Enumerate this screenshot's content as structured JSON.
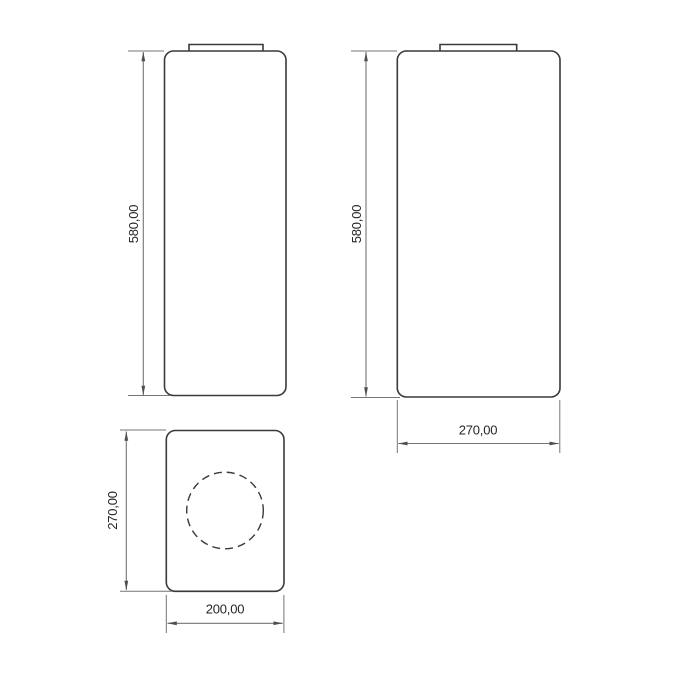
{
  "drawing": {
    "type": "technical-dimension-drawing",
    "views": {
      "front_view": {
        "name": "front-view",
        "height_dimension": "580,00"
      },
      "side_view": {
        "name": "side-view",
        "height_dimension": "580,00",
        "width_dimension": "270,00"
      },
      "top_view": {
        "name": "top-view",
        "height_dimension": "270,00",
        "width_dimension": "200,00"
      }
    },
    "colors": {
      "outline": "#3a3a3a",
      "dimension_lines": "#757575",
      "arrowheads": "#4f4f4f",
      "label_text": "#262626",
      "background": "#ffffff"
    }
  }
}
